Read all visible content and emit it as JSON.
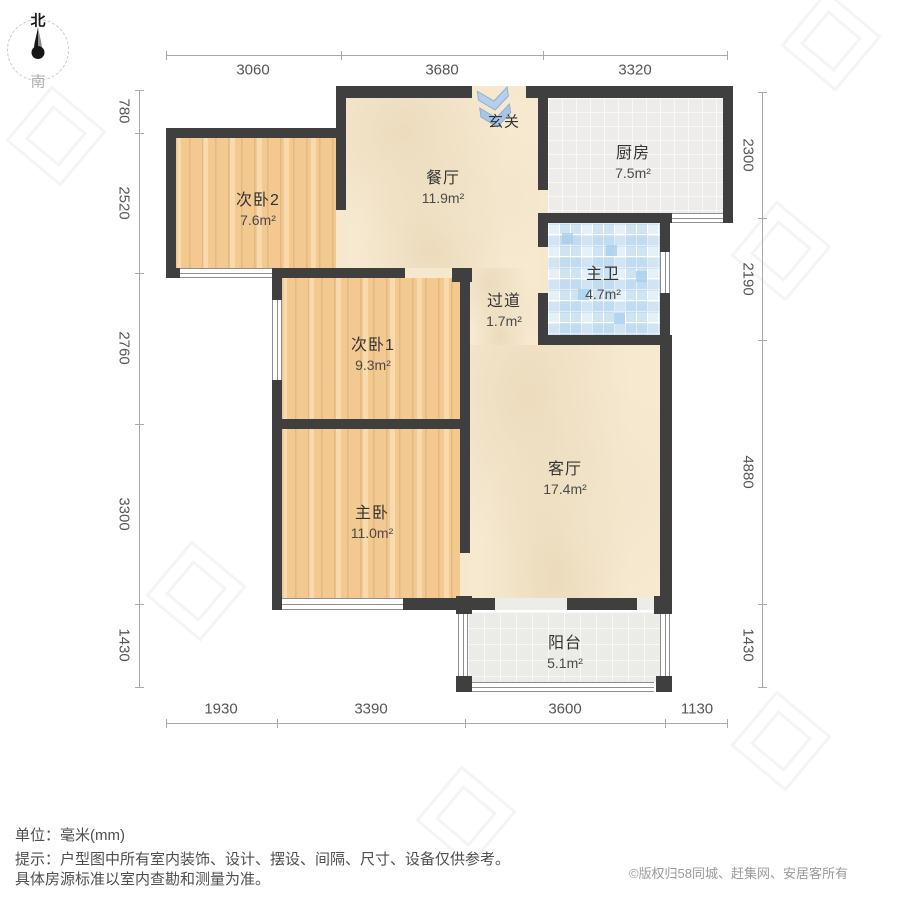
{
  "compass": {
    "north": "北",
    "south": "南"
  },
  "rooms": [
    {
      "id": "bedroom2",
      "name": "次卧2",
      "area": "7.6m²"
    },
    {
      "id": "dining",
      "name": "餐厅",
      "area": "11.9m²"
    },
    {
      "id": "kitchen",
      "name": "厨房",
      "area": "7.5m²"
    },
    {
      "id": "entry",
      "name": "玄关",
      "area": ""
    },
    {
      "id": "bath",
      "name": "主卫",
      "area": "4.7m²"
    },
    {
      "id": "bedroom1",
      "name": "次卧1",
      "area": "9.3m²"
    },
    {
      "id": "corridor",
      "name": "过道",
      "area": "1.7m²"
    },
    {
      "id": "living",
      "name": "客厅",
      "area": "17.4m²"
    },
    {
      "id": "master",
      "name": "主卧",
      "area": "11.0m²"
    },
    {
      "id": "balcony",
      "name": "阳台",
      "area": "5.1m²"
    }
  ],
  "dimensions": {
    "top": [
      "3060",
      "3680",
      "3320"
    ],
    "bottom": [
      "1930",
      "3390",
      "3600",
      "1130"
    ],
    "left": [
      "780",
      "2520",
      "2760",
      "3300",
      "1430"
    ],
    "right": [
      "2300",
      "2190",
      "4880",
      "1430"
    ]
  },
  "footer": {
    "unit": "单位：毫米(mm)",
    "tip_line1": "提示：户型图中所有室内装饰、设计、摆设、间隔、尺寸、设备仅供参考。",
    "tip_line2": "具体房源标准以室内查勘和测量为准。",
    "copyright": "©版权归58同城、赶集网、安居客所有"
  },
  "colors": {
    "wall": "#3f3f3f",
    "wood_floor": "#f2c990",
    "marble_floor": "#f6e9d0",
    "kitchen_tile": "#edecea",
    "bath_tile": "#cfe4f3",
    "balcony_tile": "#ebebe8",
    "entry_arrow": "#aac5e6",
    "dimension_text": "#555555"
  }
}
